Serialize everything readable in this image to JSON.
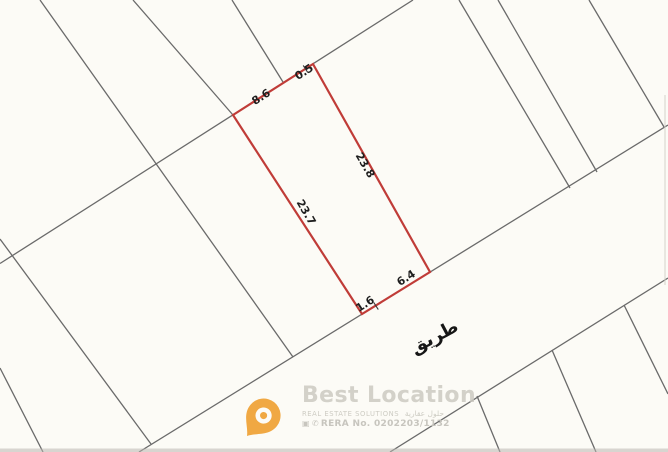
{
  "map": {
    "background_color": "#fcfbf6",
    "line_color": "#6a6a6a",
    "plot": {
      "outline_color": "#c03c38",
      "dimensions": {
        "top_primary": "8.6",
        "top_secondary": "0.5",
        "right_side": "23.8",
        "left_side": "23.7",
        "bottom_primary": "6.4",
        "bottom_secondary": "1.6"
      }
    },
    "road": {
      "label": "طريق"
    }
  },
  "watermark": {
    "brand": "Best Location",
    "tagline": "REAL ESTATE SOLUTIONS",
    "tagline_ar": "حلول عقارية",
    "rera": "RERA No. 0202203/1132",
    "pin_color": "#f0a236",
    "icons": {
      "camera": "▣",
      "phone": "✆"
    }
  }
}
